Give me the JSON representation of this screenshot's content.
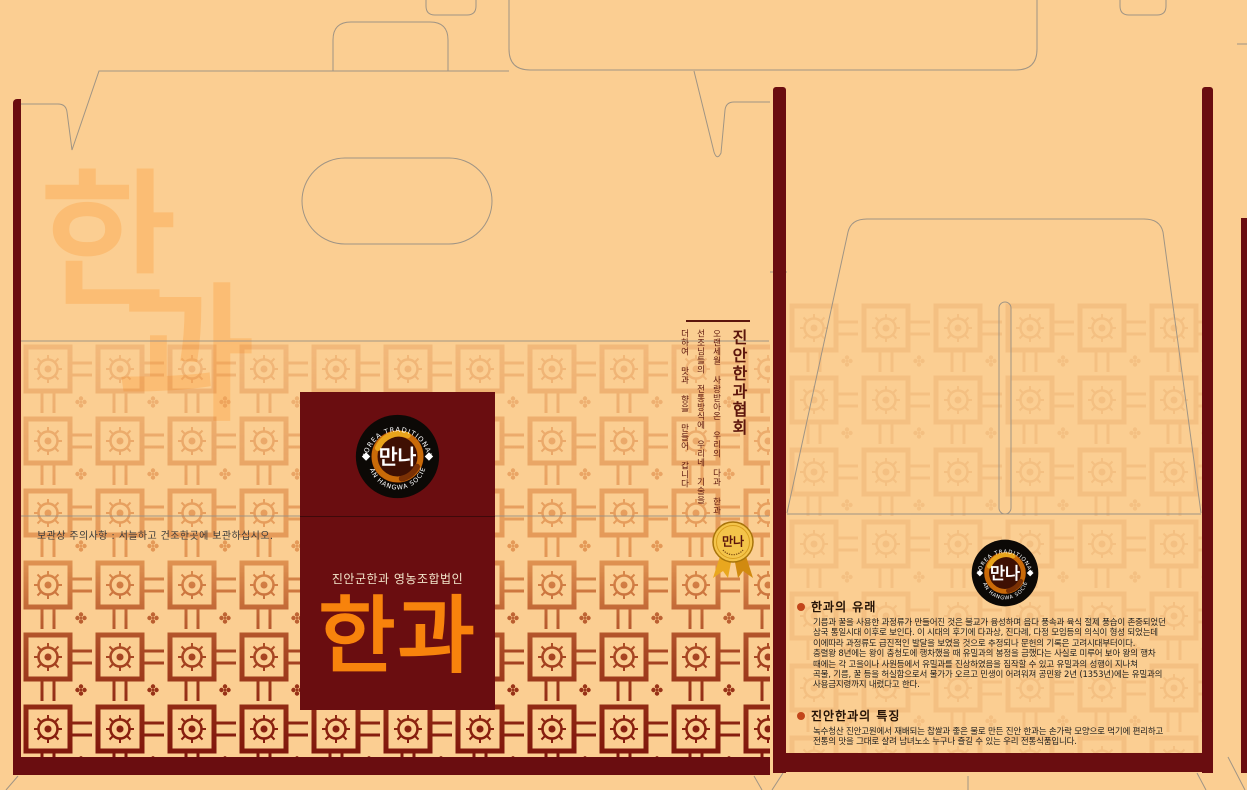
{
  "design": {
    "description_colors": {
      "background_tan": "#FBCE92",
      "maroon": "#6A0D10",
      "brand_orange": "#F8830C",
      "pattern_orange": "#D06A24",
      "pattern_red": "#7E150C",
      "medal_gold": "#F4C44A"
    }
  },
  "left_panel": {
    "watermark": {
      "char1": "한",
      "char2": "과"
    },
    "storage_notice": "보관상 주의사항 : 서늘하고 건조한곳에 보관하십시오.",
    "association": {
      "title": "진안한과협회",
      "lines": [
        "오랜세월 사랑받아온 우리의 다과 한과",
        "선조님들의 전통방식에 우리네 기술을",
        "더하여 맛과 향을 만들어 갑니다"
      ]
    },
    "brand": {
      "subtitle": "진안군한과 영농조합법인",
      "name": "한과"
    },
    "medal": {
      "label": "만나"
    }
  },
  "logo": {
    "arc_top": "JINAN KOREA TRADITIONAL FOOD",
    "arc_bottom": "JINAN HANGWA SOCIETY",
    "center": "만나"
  },
  "right_panel": {
    "sections": [
      {
        "title": "한과의 유래",
        "lines": [
          "기름과 꿀을 사용한 과정류가 만들어진 것은 불교가 융성하며 음다 풍속과 육식 절제 풍습이 존중되었던",
          "삼국 통일시대 이후로 보인다. 이 시대의 후기에 다과상, 진다례, 다정 모임등의 의식이 형성 되었는데",
          "이에따라 과정류도 급진적인 발달을 보였을 것으로 추정되나 문헌의 기록은 고려시대부터이다.",
          "충렬왕 8년에는 왕이 충청도에 행차했을 때 유밀과의 봉정을 금했다는 사실로 미루어 보아 왕의 행차",
          "때에는 각 고을이나 사원등에서 유밀과를 진상하였음을 짐작할 수 있고 유밀과의 성행이 지나쳐",
          "곡물, 기름, 꿀 등을 허실함으로서 물가가 오르고 민생이 어려워져 공민왕 2년 (1353년)에는 유밀과의",
          "사용금지령까지 내렸다고 한다."
        ]
      },
      {
        "title": "진안한과의 특징",
        "lines": [
          "녹수청산 진안고원에서 재배되는 찹쌀과 좋은 물로 만든 진안 한과는 손가락 모양으로 먹기에 편리하고",
          "전통의 맛을 그대로 살려 남녀노소 누구나 즐길 수 있는 우리 전통식품입니다."
        ]
      }
    ]
  }
}
